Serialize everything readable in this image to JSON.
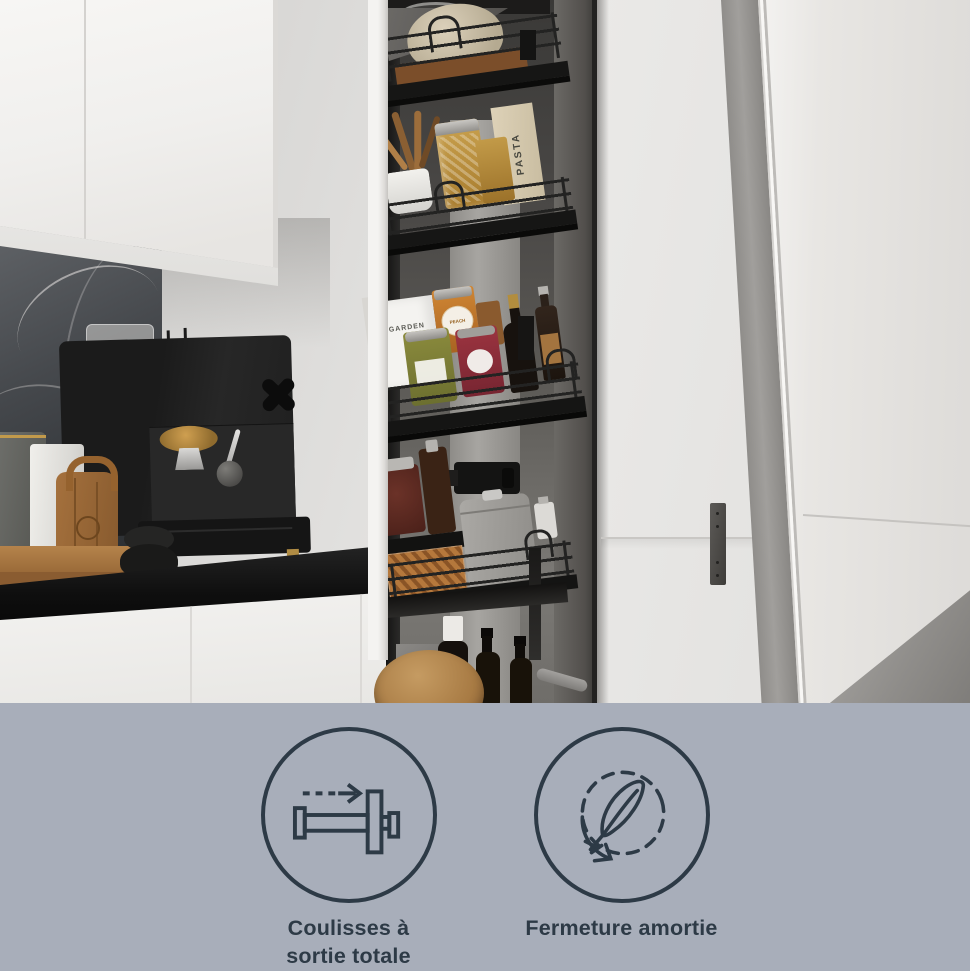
{
  "theme": {
    "band_bg": "#a8aeba",
    "accent": "#2d3a46"
  },
  "photo": {
    "labels": {
      "white_box": "GARDEN",
      "pasta_box": "PASTA",
      "jam_jar": "PEACH"
    }
  },
  "band": {
    "features": [
      {
        "icon": "full-extension-slide-icon",
        "line1": "Coulisses à",
        "line2": "sortie totale"
      },
      {
        "icon": "soft-close-feather-icon",
        "line1": "Fermeture amortie",
        "line2": ""
      }
    ]
  }
}
